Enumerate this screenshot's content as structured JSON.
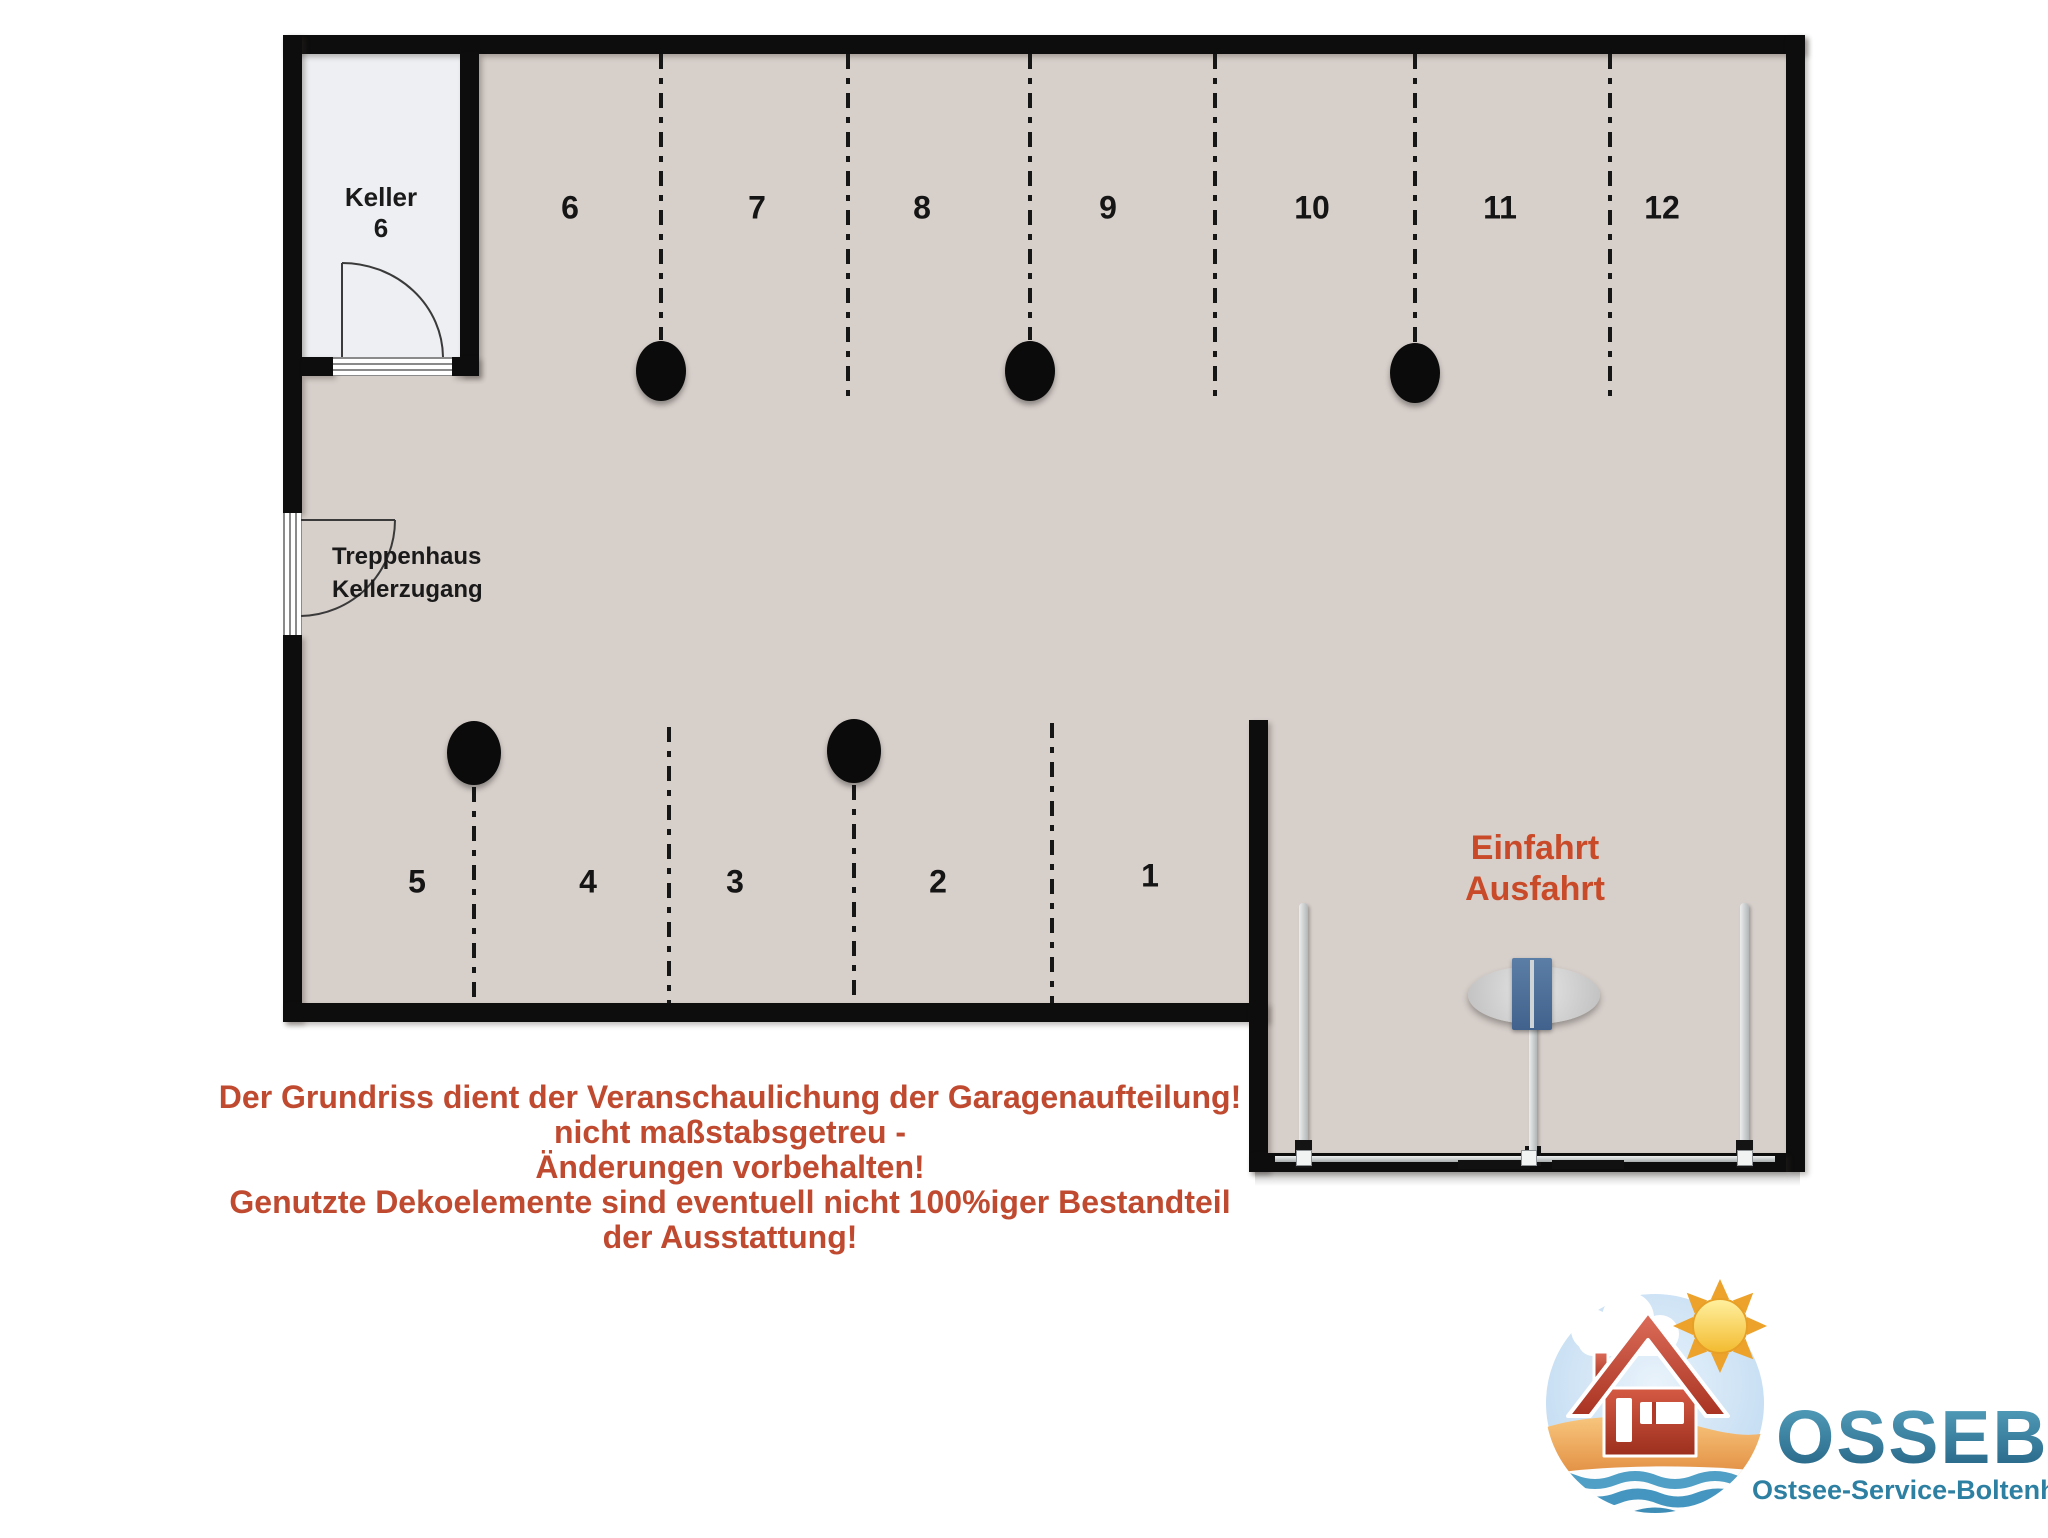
{
  "plan": {
    "keller": {
      "name": "Keller",
      "number": "6"
    },
    "stairs": {
      "line1": "Treppenhaus",
      "line2": "Kellerzugang"
    },
    "top_spaces": [
      "6",
      "7",
      "8",
      "9",
      "10",
      "11",
      "12"
    ],
    "bottom_spaces": [
      "5",
      "4",
      "3",
      "2",
      "1"
    ],
    "entrance": {
      "line1": "Einfahrt",
      "line2": "Ausfahrt"
    }
  },
  "disclaimer": {
    "lines": [
      "Der Grundriss dient der Veranschaulichung der Garagenaufteilung!",
      "nicht maßstabsgetreu -",
      "Änderungen vorbehalten!",
      "Genutzte Dekoelemente sind eventuell nicht 100%iger Bestandteil",
      "der Ausstattung!"
    ]
  },
  "logo": {
    "title": "OSSEBO",
    "subtitle": "Ostsee-Service-Boltenhagen Gm"
  },
  "colors": {
    "floor": "#d7cfca",
    "keller_floor": "#edeff2",
    "wall": "#0d0d0d",
    "disclaimer_red": "#c04a30",
    "entrance_red": "#c94a28",
    "logo_teal_dark": "#225f80",
    "logo_teal": "#2e80a3",
    "sun_yellow": "#f3bb2f",
    "house_red": "#b23a28",
    "gate_blue": "#4a6d9b"
  }
}
